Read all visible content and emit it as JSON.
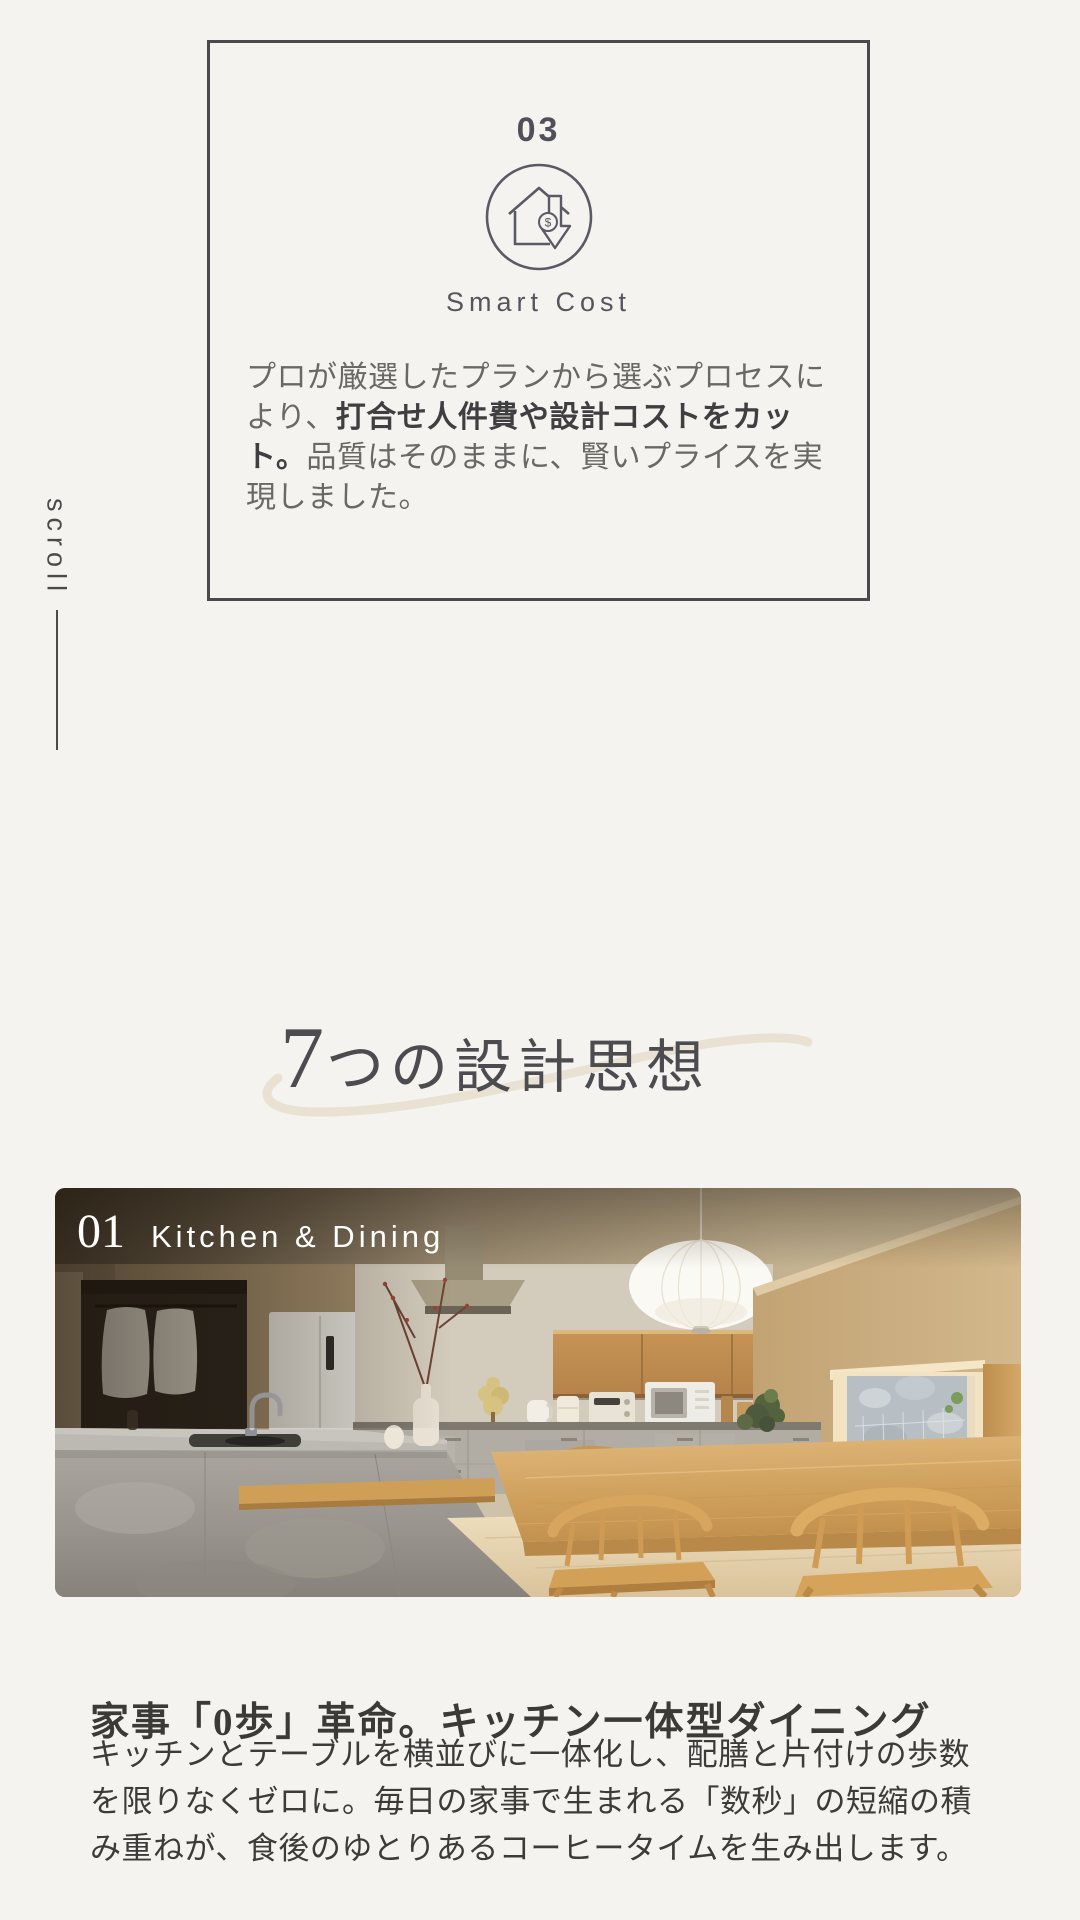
{
  "scroll": {
    "label": "scroll"
  },
  "feature_card": {
    "number": "03",
    "icon": "house-price-down-icon",
    "title": "Smart Cost",
    "body_pre": "プロが厳選したプランから選ぶプロセスにより、",
    "body_bold": "打合せ人件費や設計コストをカット。",
    "body_post": "品質はそのままに、賢いプライスを実現しました。"
  },
  "section": {
    "heading_num": "7",
    "heading_rest": "つの設計思想"
  },
  "photo": {
    "number": "01",
    "label": "Kitchen & Dining",
    "subject": "kitchen-dining-interior-photo"
  },
  "detail": {
    "heading": "家事「0歩」革命。キッチン一体型ダイニング",
    "body": "キッチンとテーブルを横並びに一体化し、配膳と片付けの歩数を限りなくゼロに。毎日の家事で生まれる「数秒」の短縮の積み重ねが、食後のゆとりあるコーヒータイムを生み出します。"
  },
  "colors": {
    "page_bg": "#f5f3ef",
    "card_border": "#4a4a4e",
    "card_text": "#55555e",
    "body_text": "#686867",
    "bold_text": "#3f3f42",
    "heading_text": "#4c4c50",
    "swoosh": "#e9e1d2",
    "photo_label": "#ffffff",
    "wood": "#cf9f58",
    "concrete": "#a5a19a",
    "detail_heading": "#3b3a37",
    "detail_body": "#3c3b39"
  }
}
